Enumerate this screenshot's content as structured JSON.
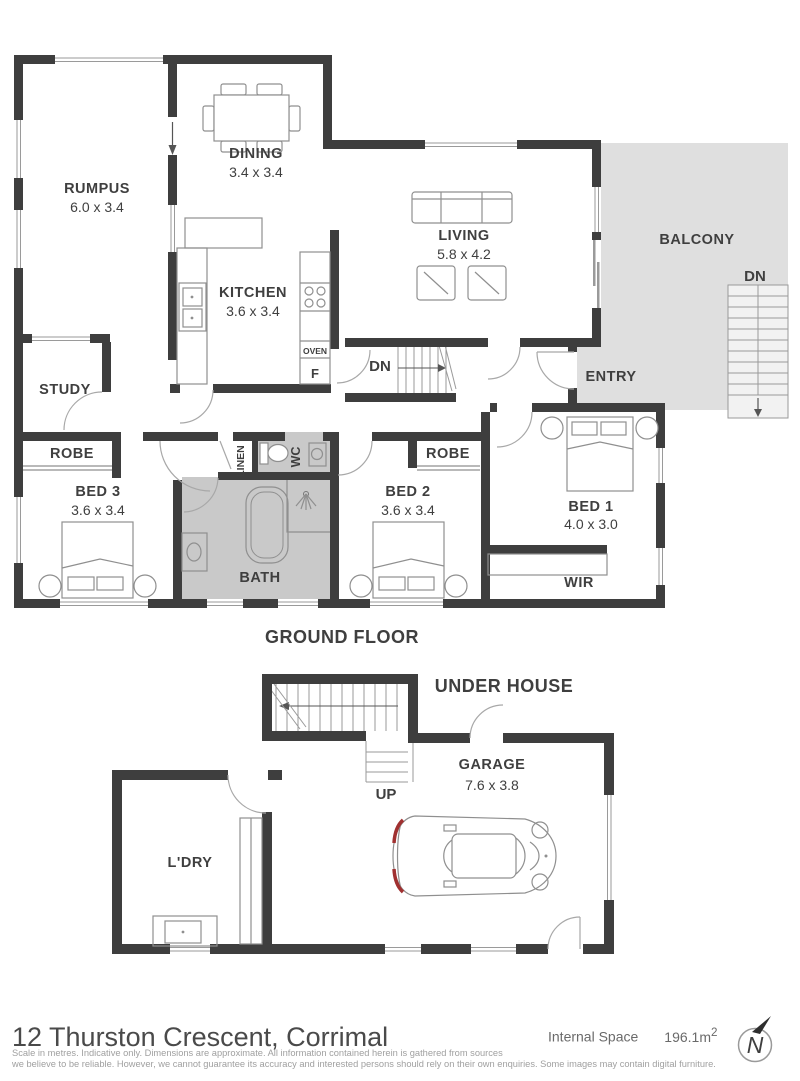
{
  "plan": {
    "ground": {
      "title": "GROUND FLOOR",
      "rumpus": {
        "name": "RUMPUS",
        "dims": "6.0 x 3.4"
      },
      "dining": {
        "name": "DINING",
        "dims": "3.4 x 3.4"
      },
      "kitchen": {
        "name": "KITCHEN",
        "dims": "3.6 x 3.4"
      },
      "living": {
        "name": "LIVING",
        "dims": "5.8 x 4.2"
      },
      "balcony": {
        "name": "BALCONY"
      },
      "balcony_stairs_label": "DN",
      "entry": {
        "name": "ENTRY"
      },
      "internal_stairs_label": "DN",
      "oven_label": "OVEN",
      "fridge_label": "F",
      "study": {
        "name": "STUDY"
      },
      "robe_bed3": {
        "name": "ROBE"
      },
      "bed3": {
        "name": "BED 3",
        "dims": "3.6 x 3.4"
      },
      "linen": {
        "name": "LINEN"
      },
      "wc": {
        "name": "WC"
      },
      "bath": {
        "name": "BATH"
      },
      "bed2": {
        "name": "BED 2",
        "dims": "3.6 x 3.4"
      },
      "robe_bed2": {
        "name": "ROBE"
      },
      "bed1": {
        "name": "BED 1",
        "dims": "4.0 x 3.0"
      },
      "wir": {
        "name": "WIR"
      }
    },
    "under": {
      "title": "UNDER HOUSE",
      "garage": {
        "name": "GARAGE",
        "dims": "7.6 x 3.8"
      },
      "ldry": {
        "name": "L'DRY"
      },
      "stairs_label": "UP"
    }
  },
  "footer": {
    "address": "12 Thurston Crescent, Corrimal",
    "internal_space_label": "Internal Space",
    "internal_space_value": "196.1m",
    "internal_space_sup": "2",
    "compass_letter": "N",
    "disclaimer_line1": "Scale in metres. Indicative only. Dimensions are approximate. All information contained herein is gathered from sources",
    "disclaimer_line2": "we believe to be reliable. However, we cannot guarantee its accuracy and interested persons should rely on their own enquiries. Some images may contain digital furniture."
  },
  "colors": {
    "wall": "#3e3e3e",
    "balcony_fill": "#dfdfdf",
    "bath_fill": "#c9c9c9",
    "tail_light_red": "#a03030",
    "label_text": "#3f3f3f",
    "disclaimer_text": "#a0a0a0"
  }
}
